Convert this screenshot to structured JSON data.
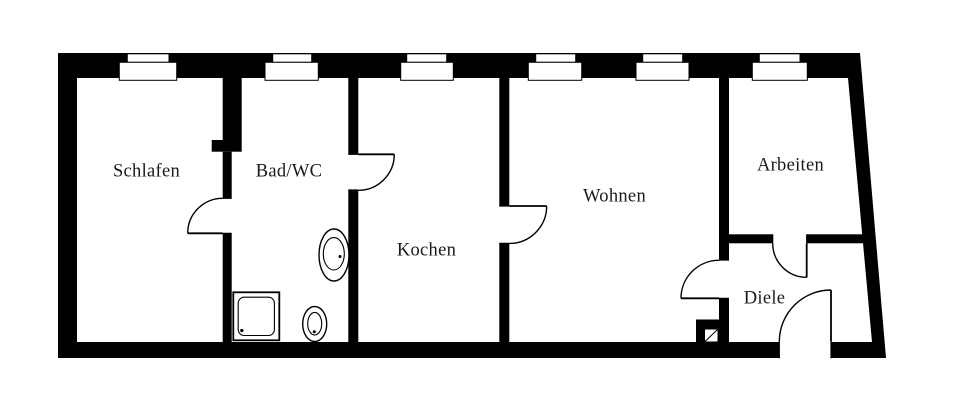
{
  "plan": {
    "background_color": "#ffffff",
    "wall_color": "#000000",
    "label_color": "#1a1a1a",
    "rooms": [
      {
        "id": "schlafen",
        "label": "Schlafen"
      },
      {
        "id": "bad-wc",
        "label": "Bad/WC"
      },
      {
        "id": "kochen",
        "label": "Kochen"
      },
      {
        "id": "wohnen",
        "label": "Wohnen"
      },
      {
        "id": "arbeiten",
        "label": "Arbeiten"
      },
      {
        "id": "diele",
        "label": "Diele"
      }
    ],
    "symbols": {
      "fixtures": [
        "shower-tray",
        "washbasin",
        "toilet",
        "chimney-flue"
      ],
      "window_symbol": "double-sill-rectangle",
      "door_symbol": "quarter-circle-swing"
    }
  }
}
